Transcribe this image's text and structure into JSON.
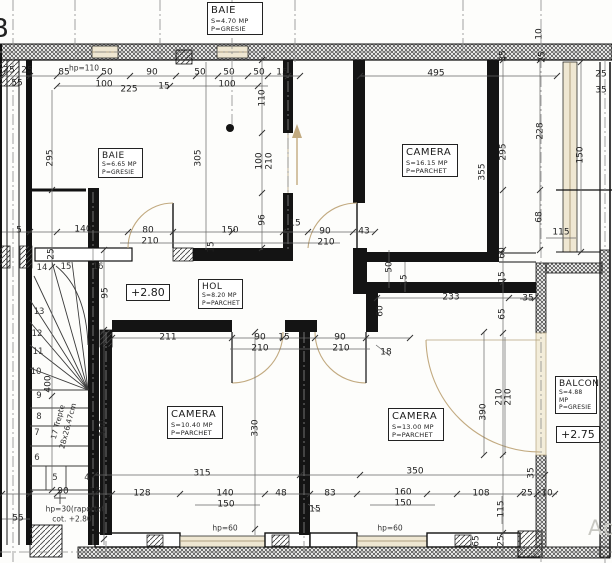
{
  "drawing_type": "apartment floor plan",
  "grid_letter": "B",
  "watermark": {
    "text": "Ad"
  },
  "rooms": [
    {
      "name": "BAIE",
      "area": "S=4.70 MP",
      "floor": "P=GRESIE"
    },
    {
      "name": "BAIE",
      "area": "S=6.65 MP",
      "floor": "P=GRESIE"
    },
    {
      "name": "CAMERA",
      "area": "S=16.15 MP",
      "floor": "P=PARCHET"
    },
    {
      "name": "HOL",
      "area": "S=8.20 MP",
      "floor": "P=PARCHET"
    },
    {
      "name": "CAMERA",
      "area": "S=10.40 MP",
      "floor": "P=PARCHET"
    },
    {
      "name": "CAMERA",
      "area": "S=13.00 MP",
      "floor": "P=PARCHET"
    },
    {
      "name": "BALCON",
      "area": "S=4.88 MP",
      "floor": "P=GRESIE"
    }
  ],
  "elevations": [
    "+2.80",
    "+2.75"
  ],
  "stairs": {
    "note_line1": "17 Trepte",
    "note_line2": "28x26.47cm",
    "steps": [
      "4",
      "5",
      "6",
      "7",
      "8",
      "9",
      "10",
      "11",
      "12",
      "13",
      "14",
      "15",
      "16"
    ]
  },
  "colors": {
    "wall": "#141414",
    "dimension_text": "#222222",
    "window_tan": "#c9b088",
    "paper": "#fdfdfb"
  },
  "dimensions": [
    {
      "t": "25",
      "x": 9,
      "y": 71
    },
    {
      "t": "25",
      "x": 27,
      "y": 71
    },
    {
      "t": "55",
      "x": 17,
      "y": 84
    },
    {
      "t": "85",
      "x": 64,
      "y": 73
    },
    {
      "t": "hp=110",
      "x": 84,
      "y": 68,
      "cls": "note"
    },
    {
      "t": "50",
      "x": 107,
      "y": 73
    },
    {
      "t": "100",
      "x": 104,
      "y": 85
    },
    {
      "t": "225",
      "x": 129,
      "y": 90
    },
    {
      "t": "90",
      "x": 152,
      "y": 73
    },
    {
      "t": "15",
      "x": 164,
      "y": 87
    },
    {
      "t": "50",
      "x": 200,
      "y": 73
    },
    {
      "t": "50",
      "x": 229,
      "y": 73
    },
    {
      "t": "100",
      "x": 227,
      "y": 85
    },
    {
      "t": "50",
      "x": 259,
      "y": 73
    },
    {
      "t": "15",
      "x": 282,
      "y": 73
    },
    {
      "t": "495",
      "x": 436,
      "y": 74
    },
    {
      "t": "110",
      "x": 263,
      "y": 98,
      "r": 90
    },
    {
      "t": "10",
      "x": 540,
      "y": 34,
      "r": 90
    },
    {
      "t": "25",
      "x": 543,
      "y": 57,
      "r": 90
    },
    {
      "t": "35",
      "x": 504,
      "y": 56,
      "r": 90
    },
    {
      "t": "25",
      "x": 601,
      "y": 75
    },
    {
      "t": "35",
      "x": 601,
      "y": 91
    },
    {
      "t": "295",
      "x": 51,
      "y": 158,
      "r": 90
    },
    {
      "t": "305",
      "x": 199,
      "y": 158,
      "r": 90
    },
    {
      "t": "295",
      "x": 504,
      "y": 152,
      "r": 90
    },
    {
      "t": "355",
      "x": 483,
      "y": 172,
      "r": 90
    },
    {
      "t": "228",
      "x": 541,
      "y": 131,
      "r": 90
    },
    {
      "t": "150",
      "x": 581,
      "y": 155,
      "r": 90
    },
    {
      "t": "68",
      "x": 540,
      "y": 217,
      "r": 90
    },
    {
      "t": "115",
      "x": 561,
      "y": 233
    },
    {
      "t": "100",
      "x": 260,
      "y": 161,
      "r": 90
    },
    {
      "t": "210",
      "x": 270,
      "y": 161,
      "r": 90
    },
    {
      "t": "96",
      "x": 263,
      "y": 220,
      "r": 90
    },
    {
      "t": "15",
      "x": 295,
      "y": 224
    },
    {
      "t": "5",
      "x": 19,
      "y": 231
    },
    {
      "t": "140",
      "x": 83,
      "y": 230
    },
    {
      "t": "80",
      "x": 148,
      "y": 231
    },
    {
      "t": "210",
      "x": 150,
      "y": 242
    },
    {
      "t": "150",
      "x": 230,
      "y": 231
    },
    {
      "t": "15",
      "x": 212,
      "y": 247,
      "r": 90
    },
    {
      "t": "90",
      "x": 325,
      "y": 232
    },
    {
      "t": "210",
      "x": 326,
      "y": 243
    },
    {
      "t": "43",
      "x": 364,
      "y": 232
    },
    {
      "t": "25",
      "x": 52,
      "y": 254,
      "r": 90
    },
    {
      "t": "50",
      "x": 390,
      "y": 267,
      "r": 90
    },
    {
      "t": "15",
      "x": 405,
      "y": 280,
      "r": 90
    },
    {
      "t": "60",
      "x": 503,
      "y": 253,
      "r": 90
    },
    {
      "t": "15",
      "x": 503,
      "y": 277,
      "r": 90
    },
    {
      "t": "233",
      "x": 451,
      "y": 298
    },
    {
      "t": "35",
      "x": 528,
      "y": 299
    },
    {
      "t": "60",
      "x": 381,
      "y": 311,
      "r": 90
    },
    {
      "t": "65",
      "x": 503,
      "y": 314,
      "r": 90
    },
    {
      "t": "211",
      "x": 168,
      "y": 338
    },
    {
      "t": "90",
      "x": 260,
      "y": 338
    },
    {
      "t": "210",
      "x": 260,
      "y": 349
    },
    {
      "t": "15",
      "x": 284,
      "y": 338
    },
    {
      "t": "90",
      "x": 340,
      "y": 338
    },
    {
      "t": "210",
      "x": 341,
      "y": 349
    },
    {
      "t": "18",
      "x": 386,
      "y": 353
    },
    {
      "t": "95",
      "x": 106,
      "y": 293,
      "r": 90
    },
    {
      "t": "400",
      "x": 49,
      "y": 384,
      "r": 90
    },
    {
      "t": "330",
      "x": 104,
      "y": 428,
      "r": 90
    },
    {
      "t": "330",
      "x": 256,
      "y": 428,
      "r": 90
    },
    {
      "t": "390",
      "x": 484,
      "y": 412,
      "r": 90
    },
    {
      "t": "210",
      "x": 500,
      "y": 397,
      "r": 90
    },
    {
      "t": "210",
      "x": 509,
      "y": 397,
      "r": 90
    },
    {
      "t": "315",
      "x": 202,
      "y": 474
    },
    {
      "t": "350",
      "x": 415,
      "y": 472
    },
    {
      "t": "90",
      "x": 63,
      "y": 492
    },
    {
      "t": "15",
      "x": 95,
      "y": 492
    },
    {
      "t": "128",
      "x": 142,
      "y": 494
    },
    {
      "t": "140",
      "x": 225,
      "y": 494
    },
    {
      "t": "150",
      "x": 226,
      "y": 505
    },
    {
      "t": "48",
      "x": 281,
      "y": 494
    },
    {
      "t": "83",
      "x": 330,
      "y": 494
    },
    {
      "t": "15",
      "x": 315,
      "y": 510
    },
    {
      "t": "160",
      "x": 403,
      "y": 493
    },
    {
      "t": "150",
      "x": 403,
      "y": 504
    },
    {
      "t": "108",
      "x": 481,
      "y": 494
    },
    {
      "t": "25",
      "x": 527,
      "y": 494
    },
    {
      "t": "10",
      "x": 547,
      "y": 494
    },
    {
      "t": "115",
      "x": 502,
      "y": 509,
      "r": 90
    },
    {
      "t": "35",
      "x": 532,
      "y": 473,
      "r": 90
    },
    {
      "t": "65",
      "x": 477,
      "y": 541,
      "r": 90
    },
    {
      "t": "25",
      "x": 502,
      "y": 541,
      "r": 90
    },
    {
      "t": "55",
      "x": 18,
      "y": 519
    },
    {
      "t": "hp=60",
      "x": 225,
      "y": 528,
      "cls": "note"
    },
    {
      "t": "hp=60",
      "x": 390,
      "y": 528,
      "cls": "note"
    },
    {
      "t": "hp=30(raportat",
      "x": 75,
      "y": 509,
      "cls": "note"
    },
    {
      "t": "cot. +2.80",
      "x": 72,
      "y": 519,
      "cls": "note"
    },
    {
      "t": "17 Trepte",
      "x": 58,
      "y": 422,
      "r": 75,
      "cls": "note"
    },
    {
      "t": "28x26.47cm",
      "x": 68,
      "y": 426,
      "r": 75,
      "cls": "note"
    },
    {
      "t": "16",
      "x": 98,
      "y": 267,
      "cls": "step"
    },
    {
      "t": "15",
      "x": 66,
      "y": 267,
      "cls": "step"
    },
    {
      "t": "14",
      "x": 42,
      "y": 268,
      "cls": "step"
    },
    {
      "t": "13",
      "x": 39,
      "y": 312,
      "cls": "step"
    },
    {
      "t": "12",
      "x": 37,
      "y": 334,
      "cls": "step"
    },
    {
      "t": "11",
      "x": 38,
      "y": 352,
      "cls": "step"
    },
    {
      "t": "10",
      "x": 36,
      "y": 372,
      "cls": "step"
    },
    {
      "t": "9",
      "x": 39,
      "y": 396,
      "cls": "step"
    },
    {
      "t": "8",
      "x": 39,
      "y": 417,
      "cls": "step"
    },
    {
      "t": "7",
      "x": 37,
      "y": 433,
      "cls": "step"
    },
    {
      "t": "6",
      "x": 37,
      "y": 458,
      "cls": "step"
    },
    {
      "t": "5",
      "x": 55,
      "y": 478,
      "cls": "step"
    },
    {
      "t": "4",
      "x": 87,
      "y": 478,
      "cls": "step"
    }
  ]
}
